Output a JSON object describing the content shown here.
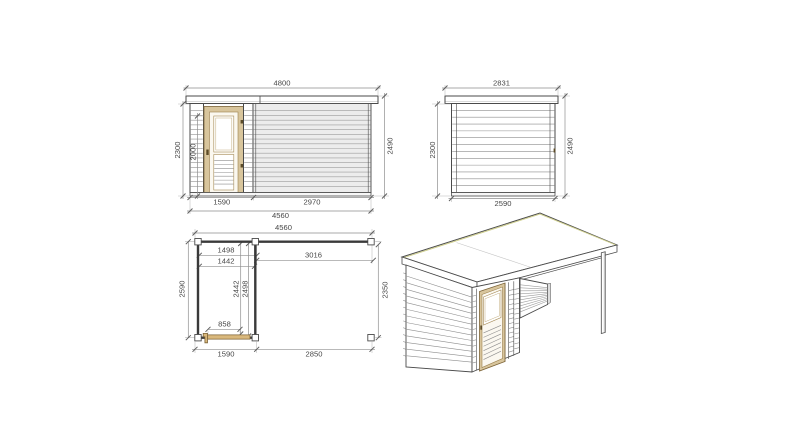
{
  "colors": {
    "background": "#ffffff",
    "outline": "#4a4a4a",
    "plan_wall": "#3a3a3a",
    "cladding_line": "#8e8e8e",
    "screen_fill": "#ececec",
    "screen_line": "#9d9d9d",
    "wood_frame": "#d8c59c",
    "wood_dark": "#7c6337",
    "plan_door": "#d9b87c",
    "hardware": "#5d4c28",
    "dim_line": "#8f8f8f",
    "dim_tick": "#5f5f5f",
    "dim_text": "#474747",
    "roof_edge_accent": "#cfcf8f"
  },
  "front_elevation": {
    "roof_width_mm": "4800",
    "total_height_mm": "2490",
    "wall_height_mm": "2300",
    "door_height_mm": "2000",
    "cabin_width_mm": "1590",
    "screen_width_mm": "2970",
    "overall_width_mm": "4560"
  },
  "side_elevation": {
    "roof_depth_mm": "2831",
    "wall_height_mm": "2300",
    "total_height_mm": "2490",
    "wall_depth_mm": "2590"
  },
  "floor_plan": {
    "overall_width_mm": "4560",
    "interior_width_a_mm": "1498",
    "interior_width_b_mm": "1442",
    "canopy_span_mm": "3016",
    "overall_depth_mm": "2590",
    "interior_depth_a_mm": "2442",
    "interior_depth_b_mm": "2498",
    "canopy_depth_mm": "2350",
    "door_opening_mm": "858",
    "cabin_width_mm": "1590",
    "canopy_width_mm": "2850"
  }
}
